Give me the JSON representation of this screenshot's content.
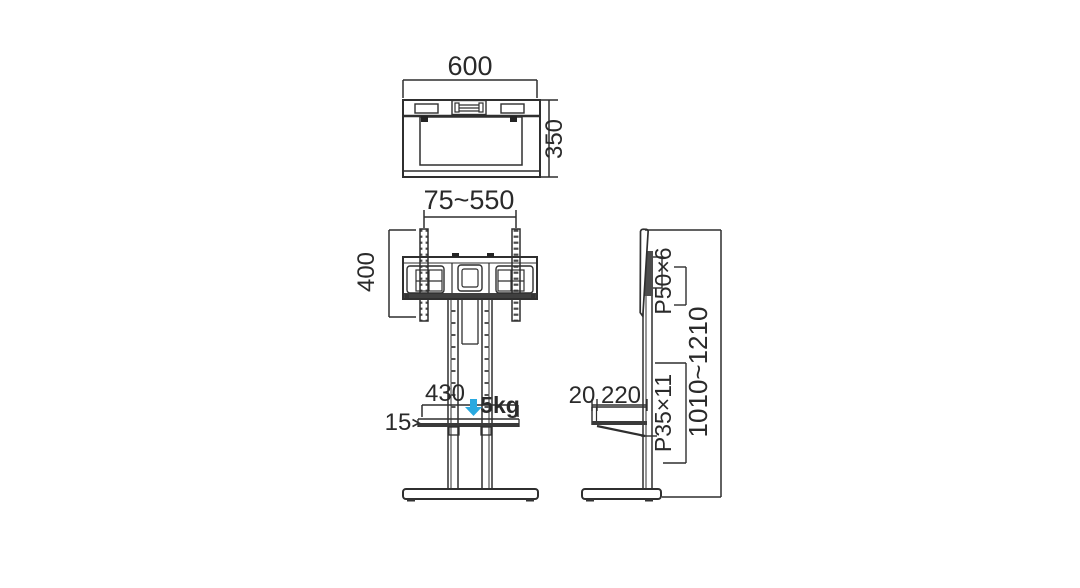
{
  "title": "TV floor stand dimensional drawing",
  "colors": {
    "accent": "#29a9e0",
    "ink": "#2f2f2f"
  },
  "views": {
    "top": {
      "width": "600",
      "depth": "350"
    },
    "front": {
      "bracket_width_range": "75~550",
      "bracket_height": "400",
      "shelf_width": "430",
      "shelf_thickness": "15",
      "shelf_load": "5kg",
      "shelf_arrow": "›"
    },
    "side": {
      "top_hole_pitch": "P50×6",
      "shelf_hole_pitch": "P35×11",
      "shelf_front_offset": "20",
      "shelf_depth": "220",
      "height_range": "1010~1210"
    }
  }
}
